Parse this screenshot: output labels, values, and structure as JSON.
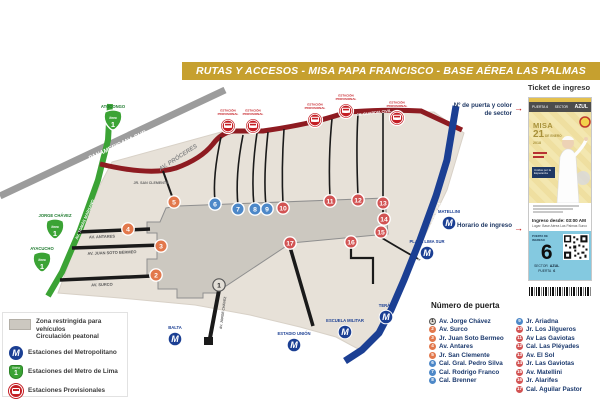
{
  "title": "RUTAS Y ACCESOS - MISA PAPA FRANCISCO - BASE AÉREA LAS PALMAS",
  "colors": {
    "banner": "#C6A02F",
    "red_route": "#8E1B21",
    "green_line": "#3BA335",
    "blue_route": "#1B3F93",
    "panamericana": "#9C9C9C",
    "land": "#E7E1D8",
    "restricted_zone": "#CCC8C0",
    "gate_orange": "#E2784C",
    "gate_blue": "#4D88C8",
    "gate_red": "#D25353",
    "gate_gray": "#E2DED6",
    "provisional_red": "#C41E24",
    "metro_green": "#3BA335"
  },
  "map": {
    "street_labels": [
      {
        "text": "PANAMERICANA SUR",
        "x": 118,
        "y": 147,
        "rot": -25,
        "size": 6,
        "color": "#FFFFFF",
        "italic": true
      },
      {
        "text": "AV. PRÓCERES",
        "x": 179,
        "y": 159,
        "rot": -33,
        "size": 6,
        "color": "#8A8A8A",
        "italic": true
      },
      {
        "text": "AV. GUARDIA CIVIL",
        "x": 374,
        "y": 114,
        "rot": -7,
        "size": 3.8,
        "color": "#FFFFFF",
        "italic": false
      },
      {
        "text": "AV. TOMÁS MARSANO",
        "x": 86,
        "y": 220,
        "rot": -67,
        "size": 4,
        "color": "#FFFFFF",
        "italic": false
      },
      {
        "text": "PROLG. PASEO DE LA REPÚBLICA",
        "x": 430,
        "y": 233,
        "rot": -70,
        "size": 3.8,
        "color": "#FFFFFF",
        "italic": false
      },
      {
        "text": "JR. SAN CLEMENTE",
        "x": 151,
        "y": 184,
        "rot": 0,
        "size": 3.6,
        "color": "#666666",
        "italic": false
      },
      {
        "text": "AV. ANTARES",
        "x": 102,
        "y": 238,
        "rot": -2,
        "size": 4,
        "color": "#555555",
        "italic": false
      },
      {
        "text": "AV. JUAN SOTO BERMEO",
        "x": 112,
        "y": 254,
        "rot": -2,
        "size": 4,
        "color": "#555555",
        "italic": false
      },
      {
        "text": "AV. SURCO",
        "x": 102,
        "y": 286,
        "rot": -2,
        "size": 4,
        "color": "#555555",
        "italic": false
      },
      {
        "text": "AV. JORGE CHÁVEZ",
        "x": 224,
        "y": 313,
        "rot": -82,
        "size": 3.4,
        "color": "#555555",
        "italic": false
      }
    ],
    "gates": [
      {
        "n": 1,
        "c": "gray",
        "x": 219,
        "y": 285
      },
      {
        "n": 2,
        "c": "orange",
        "x": 156,
        "y": 275
      },
      {
        "n": 3,
        "c": "orange",
        "x": 161,
        "y": 246
      },
      {
        "n": 4,
        "c": "orange",
        "x": 128,
        "y": 229
      },
      {
        "n": 5,
        "c": "orange",
        "x": 174,
        "y": 202
      },
      {
        "n": 6,
        "c": "blue",
        "x": 215,
        "y": 204
      },
      {
        "n": 7,
        "c": "blue",
        "x": 238,
        "y": 209
      },
      {
        "n": 8,
        "c": "blue",
        "x": 255,
        "y": 209
      },
      {
        "n": 9,
        "c": "blue",
        "x": 267,
        "y": 209
      },
      {
        "n": 10,
        "c": "red",
        "x": 283,
        "y": 208
      },
      {
        "n": 11,
        "c": "red",
        "x": 330,
        "y": 201
      },
      {
        "n": 12,
        "c": "red",
        "x": 358,
        "y": 200
      },
      {
        "n": 13,
        "c": "red",
        "x": 383,
        "y": 203
      },
      {
        "n": 14,
        "c": "red",
        "x": 384,
        "y": 219
      },
      {
        "n": 15,
        "c": "red",
        "x": 381,
        "y": 232
      },
      {
        "n": 16,
        "c": "red",
        "x": 351,
        "y": 242
      },
      {
        "n": 17,
        "c": "red",
        "x": 290,
        "y": 243
      }
    ],
    "metro_stations": [
      {
        "name": "ATOCONGO",
        "x": 113,
        "y": 121
      },
      {
        "name": "JORGE CHÁVEZ",
        "x": 55,
        "y": 230
      },
      {
        "name": "AYACUCHO",
        "x": 42,
        "y": 263
      }
    ],
    "metro_badge": {
      "line_word": "línea",
      "line_number": "1"
    },
    "metropolitano_stations": [
      {
        "name": "MATELLINI",
        "x": 449,
        "y": 223
      },
      {
        "name": "PLAZA LIMA SUR",
        "x": 427,
        "y": 253
      },
      {
        "name": "TERÁN",
        "x": 386,
        "y": 317
      },
      {
        "name": "ESTADIO UNIÓN",
        "x": 294,
        "y": 345
      },
      {
        "name": "BALTA",
        "x": 175,
        "y": 339
      },
      {
        "name": "ESCUELA MILITAR",
        "x": 345,
        "y": 332
      }
    ],
    "provisional_stations": [
      {
        "label": "ESTACIÓN PROVISIONAL",
        "x": 228,
        "y": 126
      },
      {
        "label": "ESTACIÓN PROVISIONAL",
        "x": 253,
        "y": 126
      },
      {
        "label": "ESTACIÓN PROVISIONAL",
        "x": 315,
        "y": 120
      },
      {
        "label": "ESTACIÓN PROVISIONAL",
        "x": 346,
        "y": 111
      },
      {
        "label": "ESTACIÓN PROVISIONAL",
        "x": 397,
        "y": 118
      }
    ]
  },
  "legend": {
    "items": [
      {
        "icon": "zone-swatch",
        "label": "Zona restringida para vehículos\nCirculación peatonal"
      },
      {
        "icon": "metropolitano",
        "label": "Estaciones del Metropolitano"
      },
      {
        "icon": "metro-lima",
        "label": "Estaciones del Metro de Lima"
      },
      {
        "icon": "bus",
        "label": "Estaciones Provisionales"
      }
    ]
  },
  "ticket": {
    "panel_title": "Ticket de ingreso",
    "annotation_door": "Nº de puerta y color de sector",
    "annotation_time": "Horario de ingreso",
    "header": {
      "puerta": "PUERTA 6",
      "sector_label": "SECTOR",
      "sector_value": "AZUL"
    },
    "body": {
      "misa": "MISA",
      "day": "21",
      "month": "DE ENERO",
      "year": "2018",
      "motto_line1": "Unidos por la",
      "motto_line2": "Esperanza"
    },
    "entry": {
      "time": "Ingreso desde: 03:00 AM",
      "place": "Lugar: Base Aérea Las Palmas Surco"
    },
    "blue": {
      "caption": "PUERTA DE INGRESO",
      "number": "6",
      "sector_label": "SECTOR",
      "sector_value": "AZUL",
      "puerta_label": "PUERTA",
      "puerta_value": "6"
    }
  },
  "gate_list": {
    "heading": "Número de puerta",
    "split": 8,
    "items": [
      {
        "n": 1,
        "c": "gray",
        "label": "Av. Jorge Chávez"
      },
      {
        "n": 2,
        "c": "orange",
        "label": "Av. Surco"
      },
      {
        "n": 3,
        "c": "orange",
        "label": "Jr. Juan Soto Bermeo"
      },
      {
        "n": 4,
        "c": "orange",
        "label": "Av. Antares"
      },
      {
        "n": 5,
        "c": "orange",
        "label": "Jr. San Clemente"
      },
      {
        "n": 6,
        "c": "blue",
        "label": "Cal. Gral. Pedro Silva"
      },
      {
        "n": 7,
        "c": "blue",
        "label": "Cal. Rodrigo Franco"
      },
      {
        "n": 8,
        "c": "blue",
        "label": "Cal. Brenner"
      },
      {
        "n": 9,
        "c": "blue",
        "label": "Jr. Ariadna"
      },
      {
        "n": 10,
        "c": "red",
        "label": "Jr. Los Jilgueros"
      },
      {
        "n": 11,
        "c": "red",
        "label": "Av Las Gaviotas"
      },
      {
        "n": 12,
        "c": "red",
        "label": "Cal. Las Pléyades"
      },
      {
        "n": 13,
        "c": "red",
        "label": "Av. El Sol"
      },
      {
        "n": 14,
        "c": "red",
        "label": "Jr. Las Gaviotas"
      },
      {
        "n": 15,
        "c": "red",
        "label": "Av. Matellini"
      },
      {
        "n": 16,
        "c": "red",
        "label": "Jr. Alarifes"
      },
      {
        "n": 17,
        "c": "red",
        "label": "Cal. Aguilar Pastor"
      }
    ]
  }
}
